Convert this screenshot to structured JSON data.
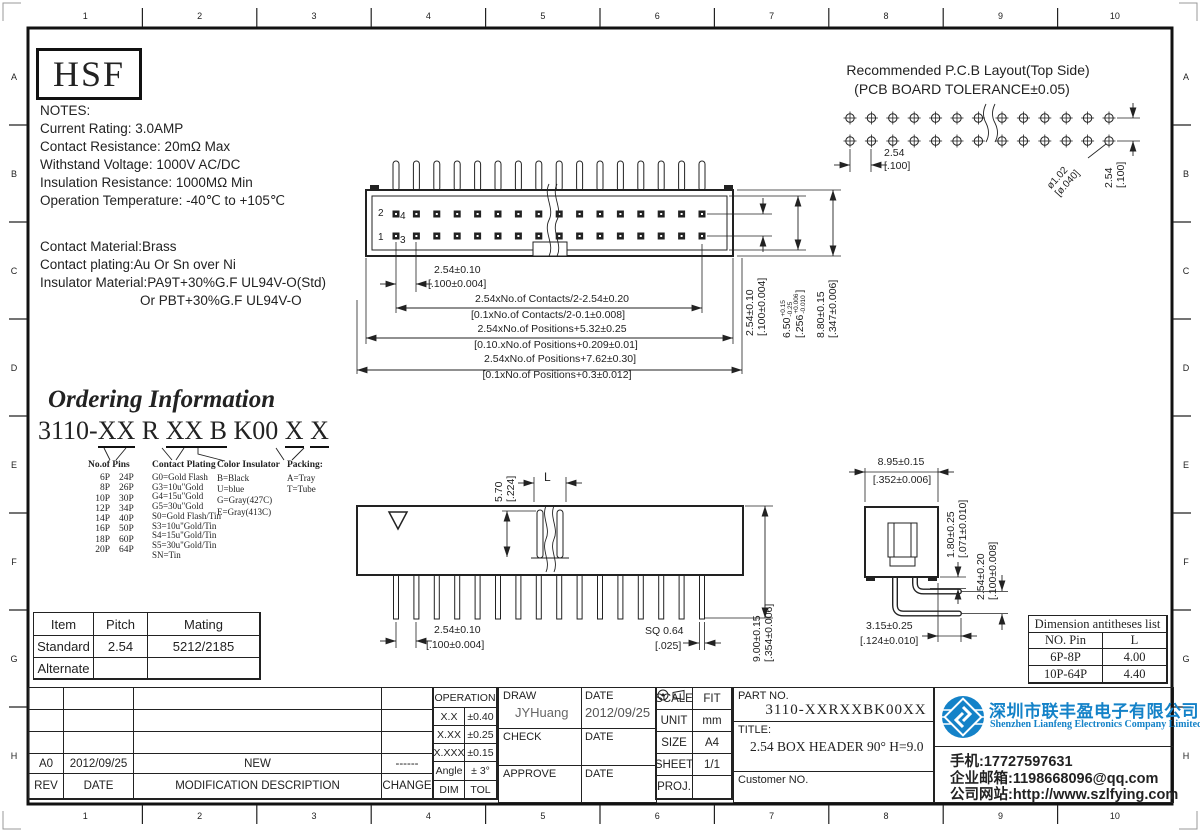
{
  "rulers": {
    "cols": [
      "1",
      "2",
      "3",
      "4",
      "5",
      "6",
      "7",
      "8",
      "9",
      "10"
    ],
    "rows": [
      "A",
      "B",
      "C",
      "D",
      "E",
      "F",
      "G",
      "H"
    ]
  },
  "brand": {
    "logo_text": "HSF"
  },
  "notes": {
    "title": "NOTES:",
    "lines": [
      "Current Rating: 3.0AMP",
      "Contact Resistance: 20mΩ Max",
      "Withstand Voltage: 1000V AC/DC",
      "Insulation Resistance: 1000MΩ Min",
      "Operation Temperature: -40℃ to +105℃"
    ],
    "material_lines": [
      "Contact Material:Brass",
      "Contact plating:Au Or Sn over Ni",
      "Insulator Material:PA9T+30%G.F UL94V-O(Std)",
      "Or PBT+30%G.F UL94V-O"
    ]
  },
  "pcb_layout": {
    "title_line1": "Recommended P.C.B Layout(Top Side)",
    "title_line2": "(PCB BOARD TOLERANCE±0.05)",
    "pitch_mm": "2.54",
    "pitch_in": "[.100]",
    "hole_mm": "ø1.02",
    "hole_in": "[ø.040]",
    "row_mm": "2.54",
    "row_in": "[.100]"
  },
  "top_view": {
    "pin1": "1",
    "pin2": "2",
    "pin3": "3",
    "pin4": "4",
    "dim_pitch_mm": "2.54±0.10",
    "dim_pitch_in": "[.100±0.004]",
    "dim_contacts_mm": "2.54xNo.of Contacts/2-2.54±0.20",
    "dim_contacts_in": "[0.1xNo.of Contacts/2-0.1±0.008]",
    "dim_positions1_mm": "2.54xNo.of Positions+5.32±0.25",
    "dim_positions1_in": "[0.10.xNo.of Positions+0.209±0.01]",
    "dim_positions2_mm": "2.54xNo.of Positions+7.62±0.30]",
    "dim_positions2_in": "[0.1xNo.of Positions+0.3±0.012]",
    "dim_row_mm": "2.54±0.10",
    "dim_row_in": "[.100±0.004]",
    "dim_h1_mm": "6.50",
    "dim_h1_tol_plus": "+0.15",
    "dim_h1_tol_minus": "-0.25",
    "dim_h1_in": "[.256",
    "dim_h1_in_tol_plus": "+0.006",
    "dim_h1_in_tol_minus": "-0.010",
    "dim_h1_in_close": "]",
    "dim_h2_mm": "8.80±0.15",
    "dim_h2_in": "[.347±0.006]"
  },
  "front_view": {
    "dim_tail_mm": "5.70",
    "dim_tail_in": "[.224]",
    "dim_L": "L",
    "dim_pitch_mm": "2.54±0.10",
    "dim_pitch_in": "[.100±0.004]",
    "dim_sq_mm": "SQ 0.64",
    "dim_sq_in": "[.025]",
    "dim_height_mm": "9.00±0.15",
    "dim_height_in": "[.354±0.006]"
  },
  "side_view": {
    "dim_width_mm": "8.95±0.15",
    "dim_width_in": "[.352±0.006]",
    "dim_pin_mm": "1.80±0.25",
    "dim_pin_in": "[.071±0.010]",
    "dim_row_mm": "2.54±0.20",
    "dim_row_in": "[.100±0.008]",
    "dim_tail_mm": "3.15±0.25",
    "dim_tail_in": "[.124±0.010]"
  },
  "ordering": {
    "title": "Ordering Information",
    "code_segments": [
      {
        "t": "3110-",
        "u": false
      },
      {
        "t": "XX",
        "u": true
      },
      {
        "t": " R ",
        "u": false
      },
      {
        "t": "XX",
        "u": true
      },
      {
        "t": " B",
        "u": true
      },
      {
        "t": " K00 ",
        "u": false
      },
      {
        "t": "X",
        "u": true
      },
      {
        "t": " ",
        "u": false
      },
      {
        "t": "X",
        "u": true
      }
    ],
    "columns": [
      {
        "header": "No.of Pins",
        "items": [
          [
            "6P",
            "24P"
          ],
          [
            "8P",
            "26P"
          ],
          [
            "10P",
            "30P"
          ],
          [
            "12P",
            "34P"
          ],
          [
            "14P",
            "40P"
          ],
          [
            "16P",
            "50P"
          ],
          [
            "18P",
            "60P"
          ],
          [
            "20P",
            "64P"
          ]
        ]
      },
      {
        "header": "Contact Plating",
        "items": [
          "G0=Gold Flash",
          "G3=10u\"Gold",
          "G4=15u\"Gold",
          "G5=30u\"Gold",
          "S0=Gold Flash/Tin",
          "S3=10u\"Gold/Tin",
          "S4=15u\"Gold/Tin",
          "S5=30u\"Gold/Tin",
          "SN=Tin"
        ]
      },
      {
        "header": "Color Insulator",
        "items": [
          "B=Black",
          "U=blue",
          "G=Gray(427C)",
          "E=Gray(413C)"
        ]
      },
      {
        "header": "Packing:",
        "items": [
          "A=Tray",
          "T=Tube"
        ]
      }
    ]
  },
  "item_table": {
    "headers": [
      "Item",
      "Pitch",
      "Mating"
    ],
    "rows": [
      [
        "Standard",
        "2.54",
        "5212/2185"
      ],
      [
        "Alternate",
        "",
        ""
      ]
    ]
  },
  "dim_list": {
    "title": "Dimension antitheses list",
    "headers": [
      "NO. Pin",
      "L"
    ],
    "rows": [
      [
        "6P-8P",
        "4.00"
      ],
      [
        "10P-64P",
        "4.40"
      ]
    ]
  },
  "revision_table": {
    "headers": [
      "REV",
      "DATE",
      "MODIFICATION DESCRIPTION",
      "CHANGE"
    ],
    "rows": [
      [
        "A0",
        "2012/09/25",
        "NEW",
        "------"
      ]
    ]
  },
  "tolerance_table": {
    "title": "OPERATION",
    "rows": [
      [
        "X.X",
        "±0.40"
      ],
      [
        "X.XX",
        "±0.25"
      ],
      [
        "X.XXX",
        "±0.15"
      ],
      [
        "Angle",
        "± 3°"
      ],
      [
        "DIM",
        "TOL"
      ]
    ]
  },
  "sign_block": {
    "draw_label": "DRAW",
    "draw_name": "JYHuang",
    "draw_date_label": "DATE",
    "draw_date": "2012/09/25",
    "check_label": "CHECK",
    "check_date_label": "DATE",
    "approve_label": "APPROVE",
    "approve_date_label": "DATE"
  },
  "info_table": {
    "scale_label": "SCALE",
    "scale": "FIT",
    "unit_label": "UNIT",
    "unit": "mm",
    "size_label": "SIZE",
    "size": "A4",
    "sheet_label": "SHEET",
    "sheet": "1/1",
    "proj_label": "PROJ."
  },
  "part_block": {
    "part_no_label": "PART NO.",
    "part_no": "3110-XXRXXBK00XX",
    "title_label": "TITLE:",
    "title": "2.54 BOX HEADER 90° H=9.0",
    "customer_label": "Customer NO."
  },
  "company": {
    "name_cn": "深圳市联丰盈电子有限公司",
    "name_en": "Shenzhen Lianfeng Electronics Company Limited",
    "phone": "手机:17727597631",
    "email": "企业邮箱:1198668096@qq.com",
    "website": "公司网站:http://www.szlfying.com",
    "brand_blue": "#1482c8"
  }
}
